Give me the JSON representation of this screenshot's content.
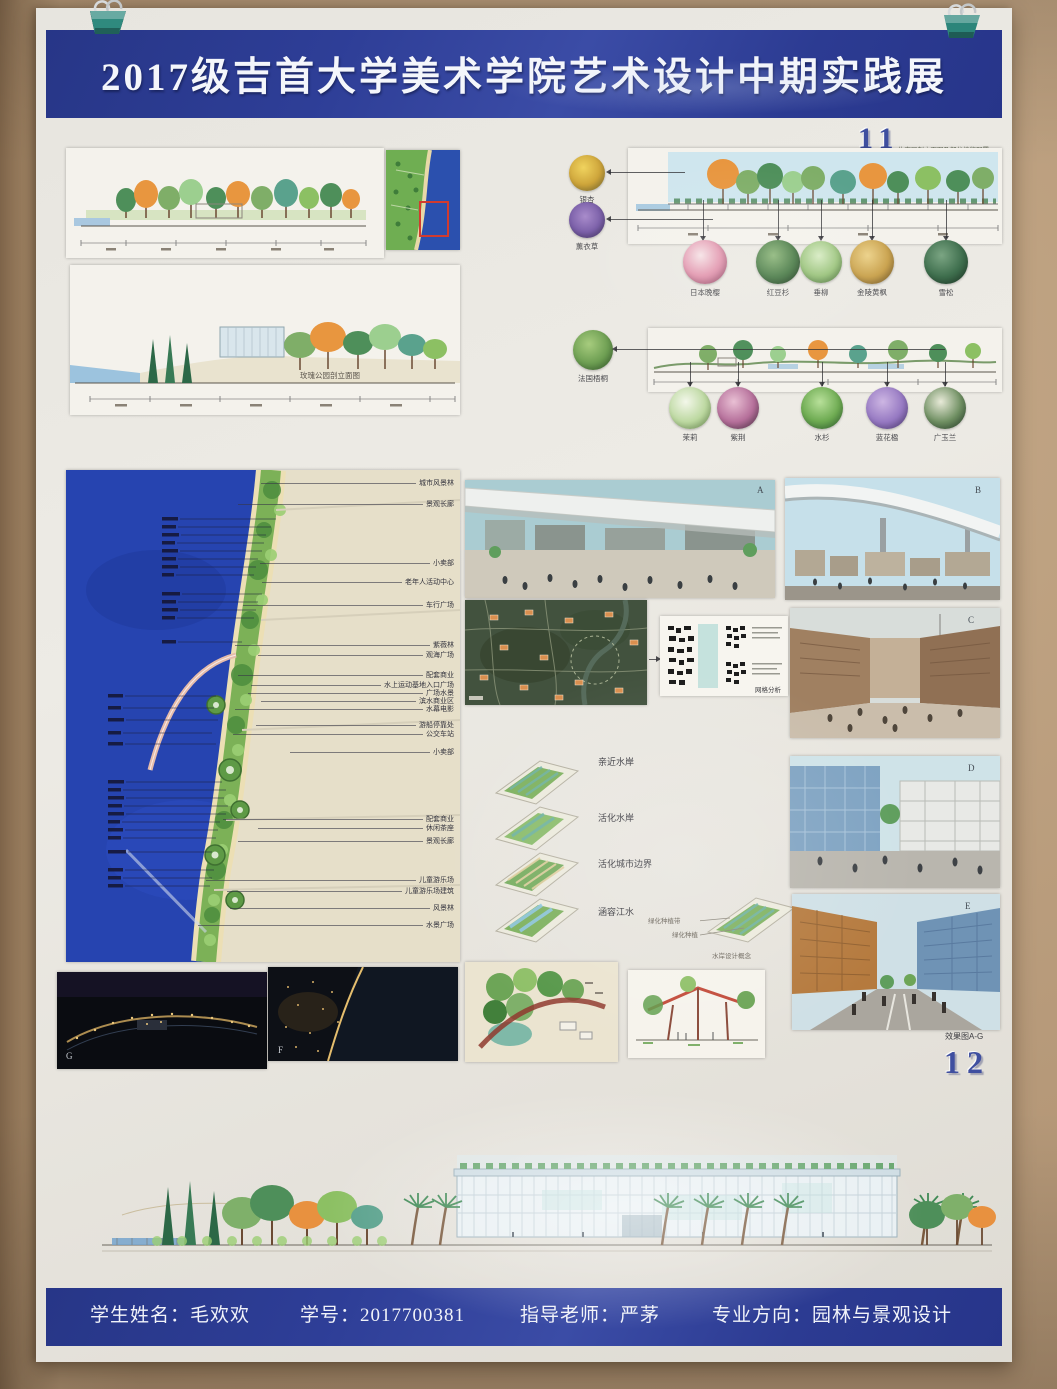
{
  "poster": {
    "title": "2017级吉首大学美术学院艺术设计中期实践展",
    "page_number_top": "11",
    "page_top_note": "生态区剖立面图及部分植物配置",
    "page_number_bottom": "12",
    "renders_caption": "效果图A-G",
    "rose_park_caption": "玫瑰公园剖立面图"
  },
  "plants": {
    "upper_side": [
      "银杏",
      "薰衣草"
    ],
    "upper_row": [
      "日本晚樱",
      "红豆杉",
      "垂柳",
      "金陵黄枫",
      "雪松"
    ],
    "lower_side": [
      "法国梧桐"
    ],
    "lower_row": [
      "茉莉",
      "紫荆",
      "水杉",
      "蓝花楹",
      "广玉兰"
    ]
  },
  "plan": {
    "right_top": [
      "城市风景林",
      "景观长廊",
      "小卖部",
      "老年人活动中心",
      "车行广场",
      "紫薇林",
      "观海广场",
      "配套商业",
      "水上运动基地入口广场",
      "广场水景",
      "滨水商业区",
      "水幕电影"
    ],
    "right_bottom": [
      "游船停靠处",
      "公交车站",
      "小卖部",
      "配套商业",
      "休闲茶座",
      "景观长廊",
      "儿童游乐场",
      "儿童游乐场建筑",
      "风景林",
      "水景广场"
    ]
  },
  "diagrams": {
    "axon_labels": [
      "亲近水岸",
      "活化水岸",
      "活化城市边界",
      "涵容江水"
    ],
    "grid_caption": "网格分析",
    "mini_notes": [
      "绿化种植带",
      "绿化种植"
    ],
    "mini_caption": "水岸设计概念"
  },
  "letters": {
    "a": "A",
    "b": "B",
    "c": "C",
    "d": "D",
    "e": "E",
    "f": "F",
    "g": "G"
  },
  "footer": {
    "student_name_label": "学生姓名：",
    "student_name": "毛欢欢",
    "student_id_label": "学号：",
    "student_id": "2017700381",
    "teacher_label": "指导老师：",
    "teacher": "严茅",
    "major_label": "专业方向：",
    "major": "园林与景观设计"
  },
  "colors": {
    "header_blue": "#2c3b96",
    "page_number_blue": "#3f4fa0",
    "wall_tan": "#b69a7b",
    "paper": "#e9e7e1",
    "plan_sea_blue": "#2644b0"
  }
}
